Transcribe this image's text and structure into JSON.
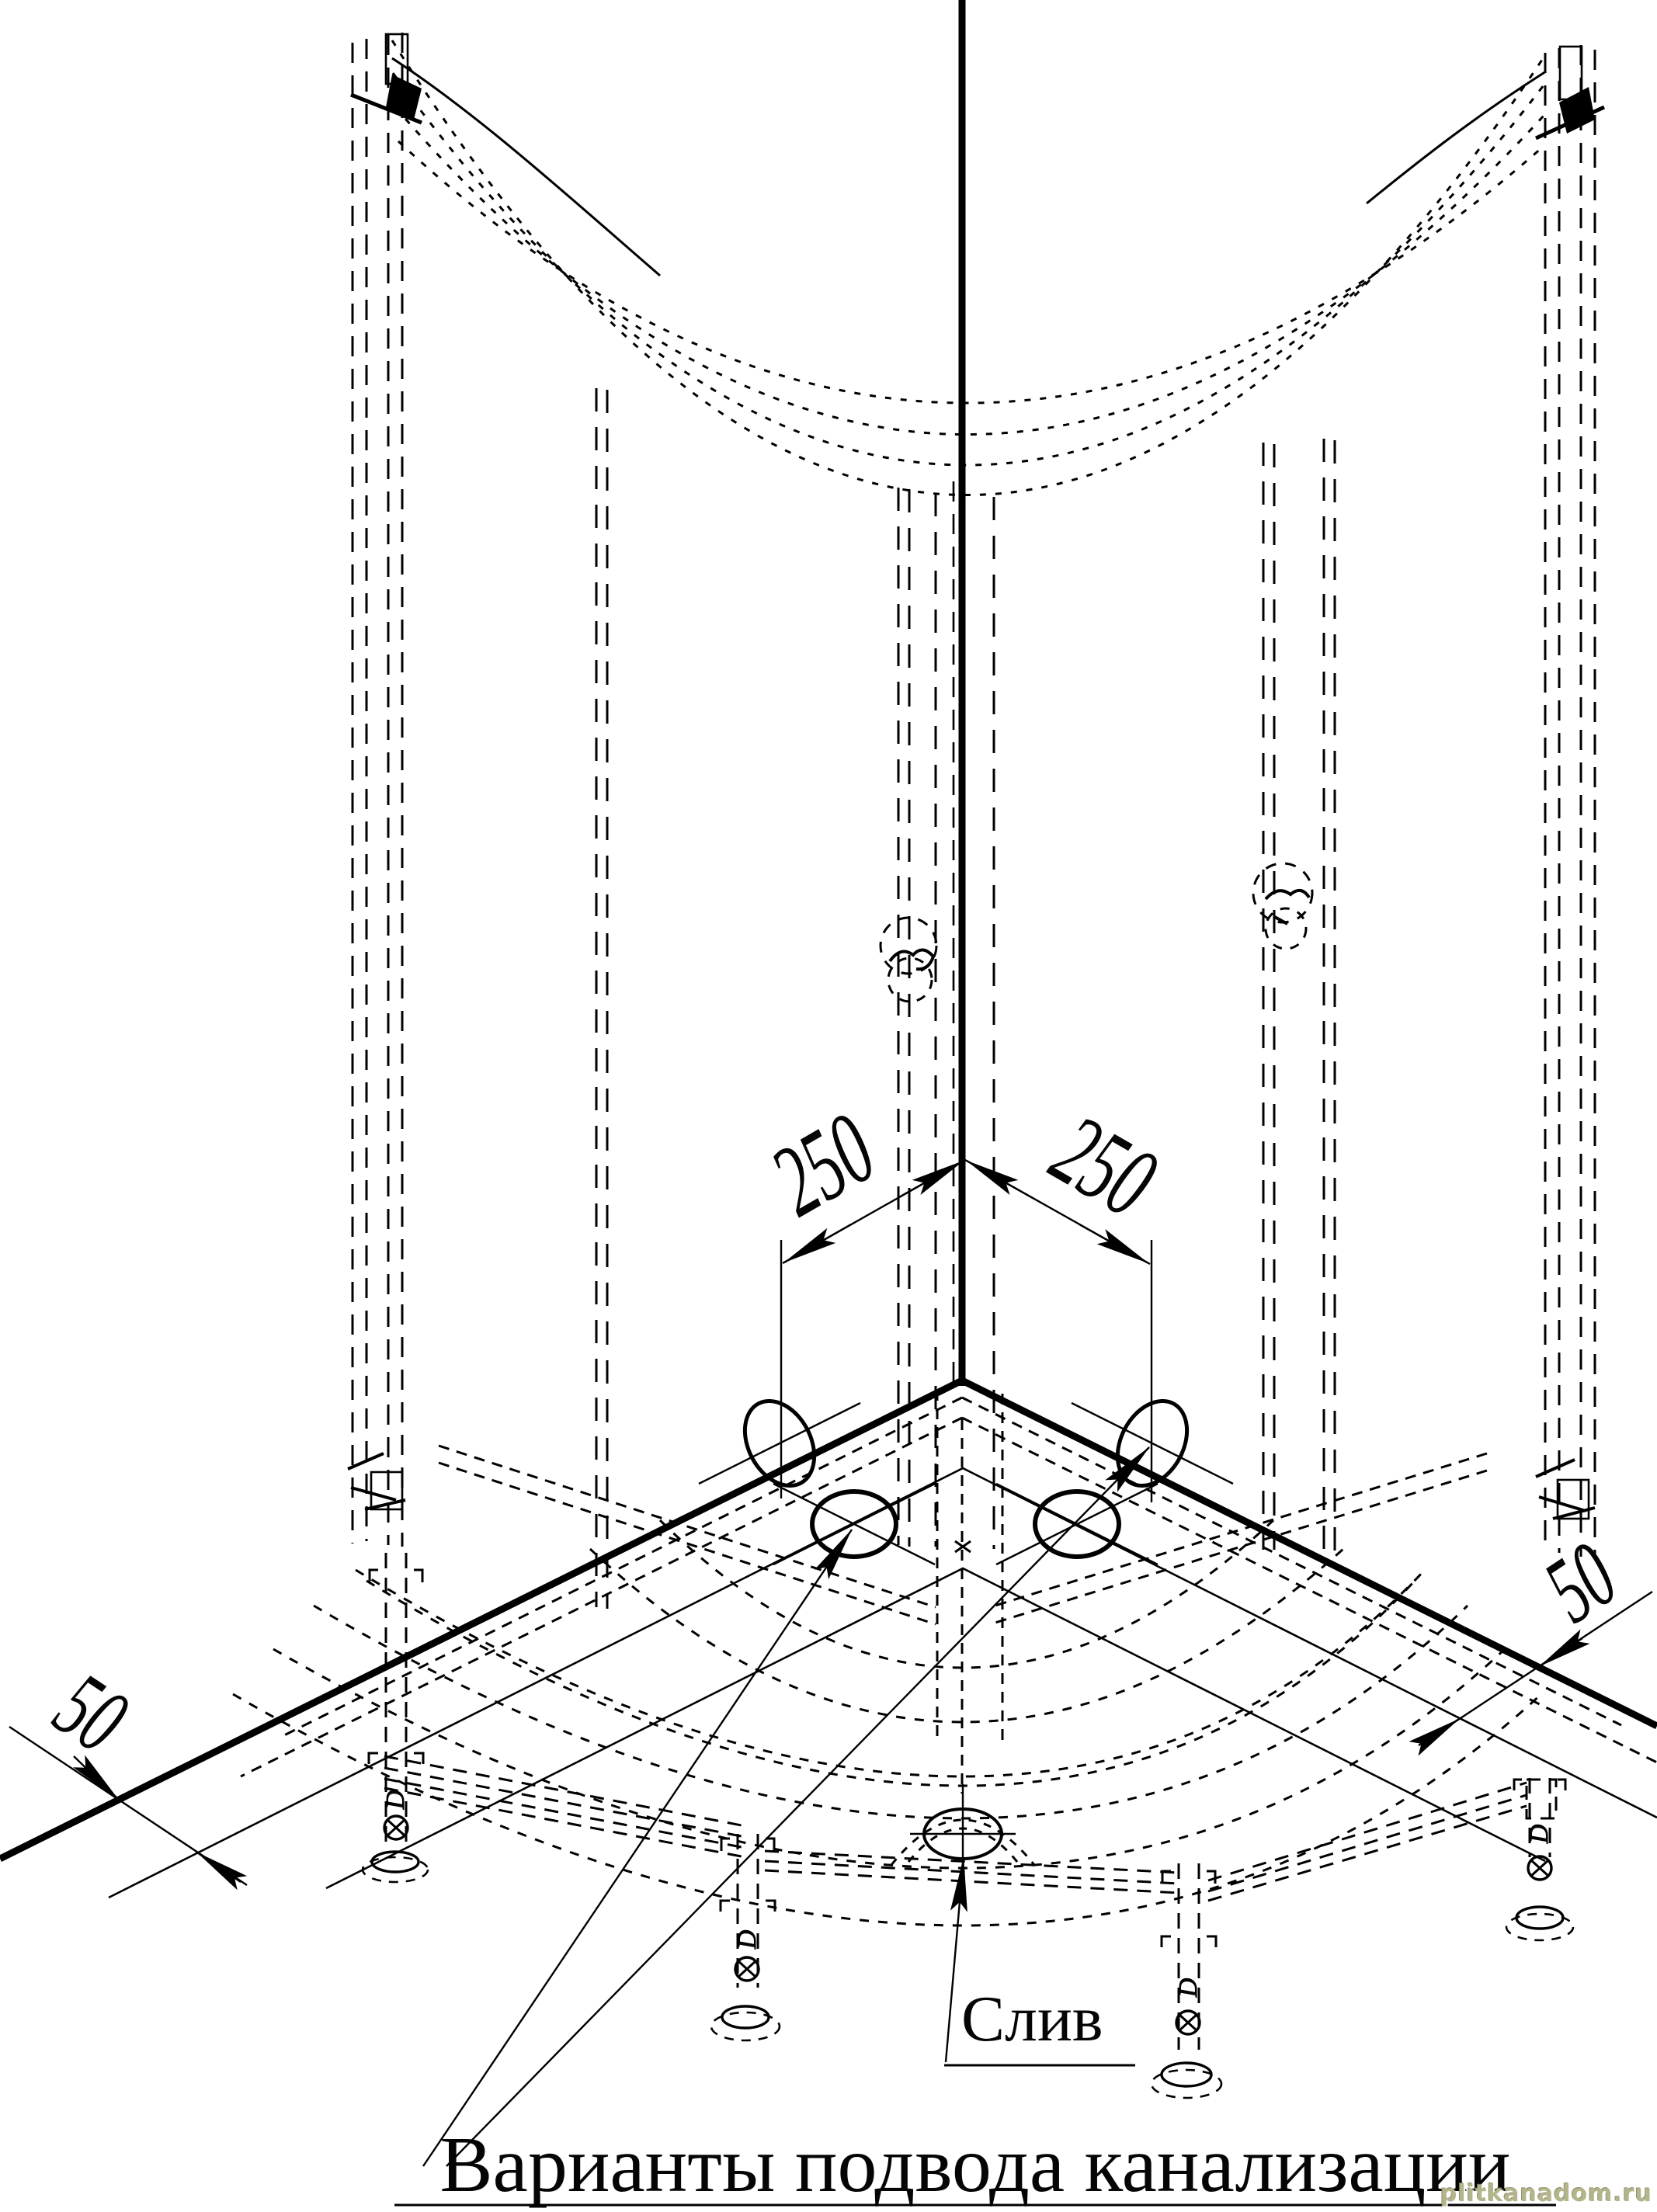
{
  "drawing": {
    "type": "technical installation drawing",
    "subject": "corner shower cabin with quarter-circle tray, frame, adjustable legs and drain connection options",
    "background_color": "#ffffff",
    "line_color": "#000000"
  },
  "dimensions": {
    "drain_offset_left": "250",
    "drain_offset_right": "250",
    "wall_gap_left": "50",
    "wall_gap_right": "50"
  },
  "labels": {
    "drain": "Слив",
    "options": "Варианты подвода канализации",
    "leg_marking": "D"
  },
  "watermark": {
    "text": "plitkanadom.ru",
    "color": "#b5b58c"
  }
}
